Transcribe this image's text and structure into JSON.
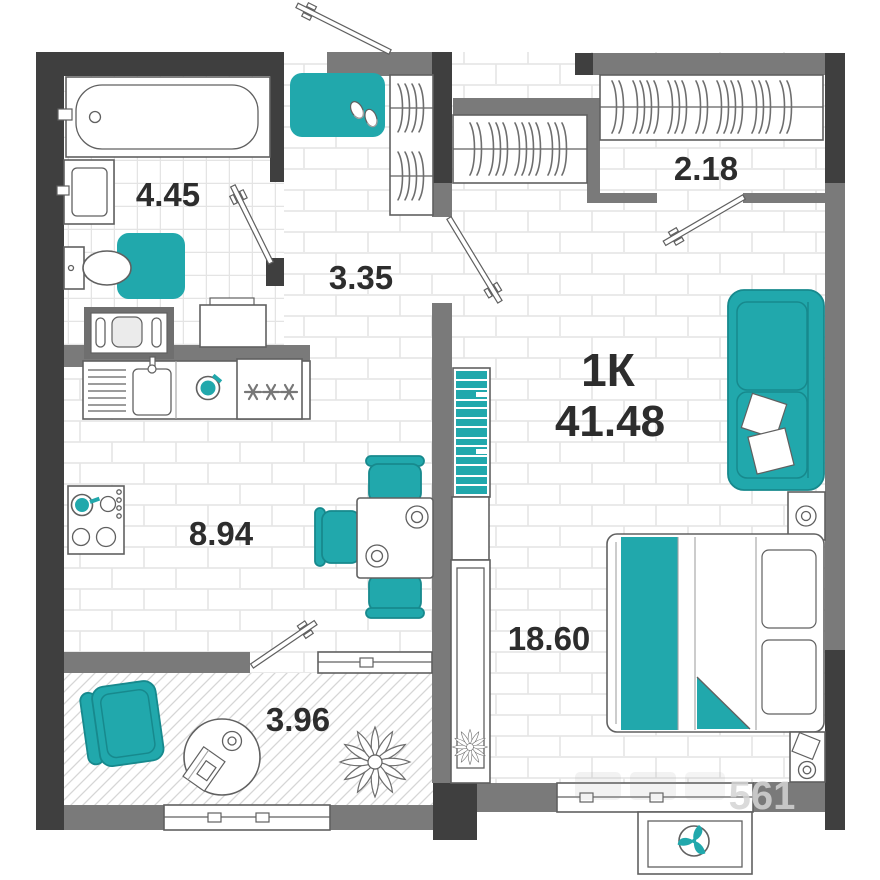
{
  "plan": {
    "title": "1К",
    "total_area": "41.48",
    "watermark": "561",
    "stove_symbol": "***",
    "rooms": {
      "bathroom": {
        "area": "4.45"
      },
      "hallway": {
        "area": "3.35"
      },
      "wardrobe": {
        "area": "2.18"
      },
      "kitchen": {
        "area": "8.94"
      },
      "living_room": {
        "area": "18.60"
      },
      "balcony": {
        "area": "3.96"
      }
    },
    "colors": {
      "teal": "#21a8ac",
      "teal_dark": "#17898d",
      "wall_dark": "#3f3f3f",
      "wall_gray": "#7a7a7a",
      "line": "#606060",
      "text": "#2d2d2d",
      "floor_line": "#e4e4e4",
      "watermark_color": "#d4d4d4"
    }
  }
}
